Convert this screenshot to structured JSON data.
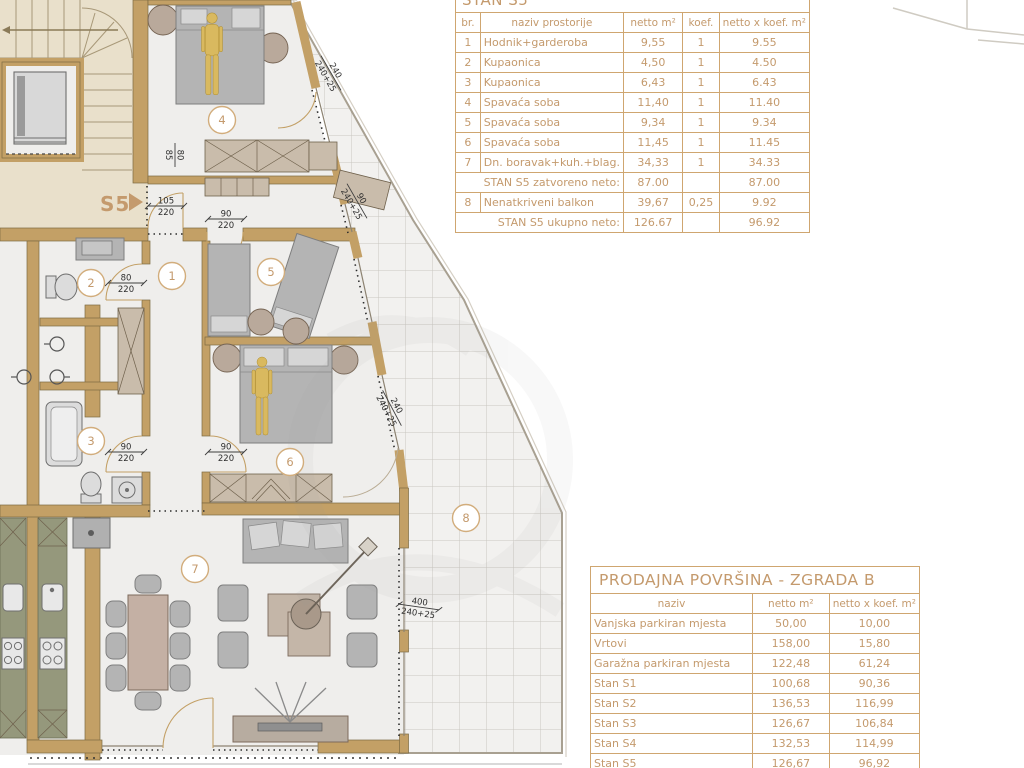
{
  "plan": {
    "apartment_label": "S5",
    "room_markers": [
      "1",
      "2",
      "3",
      "4",
      "5",
      "6",
      "7",
      "8"
    ],
    "dimensions": [
      {
        "top": "105",
        "bottom": "220"
      },
      {
        "top": "90",
        "bottom": "220"
      },
      {
        "top": "80",
        "bottom": "220"
      },
      {
        "top": "90",
        "bottom": "220"
      },
      {
        "top": "90",
        "bottom": "220"
      },
      {
        "top": "240",
        "bottom": "240+25"
      },
      {
        "top": "90",
        "bottom": "240+25"
      },
      {
        "top": "240",
        "bottom": "240+25"
      },
      {
        "top": "400",
        "bottom": "240+25"
      },
      {
        "top": "80",
        "bottom": "85"
      }
    ],
    "colors": {
      "wall": "#c3a066",
      "floor": "#efeeec",
      "common_area": "#e9e0cb",
      "kitchen_counter": "#95987c",
      "accent": "#c49a6d"
    }
  },
  "table_s5": {
    "title": "STAN S5",
    "headers": {
      "br": "br.",
      "naziv": "naziv prostorije",
      "netto": "netto m²",
      "koef": "koef.",
      "total": "netto x koef. m²"
    },
    "rows": [
      {
        "br": "1",
        "naziv": "Hodnik+garderoba",
        "netto": "9,55",
        "koef": "1",
        "total": "9.55"
      },
      {
        "br": "2",
        "naziv": "Kupaonica",
        "netto": "4,50",
        "koef": "1",
        "total": "4.50"
      },
      {
        "br": "3",
        "naziv": "Kupaonica",
        "netto": "6,43",
        "koef": "1",
        "total": "6.43"
      },
      {
        "br": "4",
        "naziv": "Spavaća soba",
        "netto": "11,40",
        "koef": "1",
        "total": "11.40"
      },
      {
        "br": "5",
        "naziv": "Spavaća soba",
        "netto": "9,34",
        "koef": "1",
        "total": "9.34"
      },
      {
        "br": "6",
        "naziv": "Spavaća soba",
        "netto": "11,45",
        "koef": "1",
        "total": "11.45"
      },
      {
        "br": "7",
        "naziv": "Dn. boravak+kuh.+blag.",
        "netto": "34,33",
        "koef": "1",
        "total": "34.33"
      },
      {
        "br": "",
        "naziv": "STAN S5 zatvoreno neto:",
        "netto": "87.00",
        "koef": "",
        "total": "87.00"
      },
      {
        "br": "8",
        "naziv": "Nenatkriveni balkon",
        "netto": "39,67",
        "koef": "0,25",
        "total": "9.92"
      },
      {
        "br": "",
        "naziv": "STAN S5 ukupno neto:",
        "netto": "126.67",
        "koef": "",
        "total": "96.92"
      }
    ]
  },
  "table_prodajna": {
    "title": "PRODAJNA POVRŠINA - ZGRADA B",
    "headers": {
      "naziv": "naziv",
      "netto": "netto m²",
      "total": "netto x koef. m²"
    },
    "rows": [
      {
        "naziv": "Vanjska parkiran mjesta",
        "netto": "50,00",
        "total": "10,00"
      },
      {
        "naziv": "Vrtovi",
        "netto": "158,00",
        "total": "15,80"
      },
      {
        "naziv": "Garažna parkiran mjesta",
        "netto": "122,48",
        "total": "61,24"
      },
      {
        "naziv": "Stan S1",
        "netto": "100,68",
        "total": "90,36"
      },
      {
        "naziv": "Stan S2",
        "netto": "136,53",
        "total": "116,99"
      },
      {
        "naziv": "Stan S3",
        "netto": "126,67",
        "total": "106,84"
      },
      {
        "naziv": "Stan S4",
        "netto": "132,53",
        "total": "114,99"
      },
      {
        "naziv": "Stan S5",
        "netto": "126,67",
        "total": "96,92"
      }
    ]
  }
}
